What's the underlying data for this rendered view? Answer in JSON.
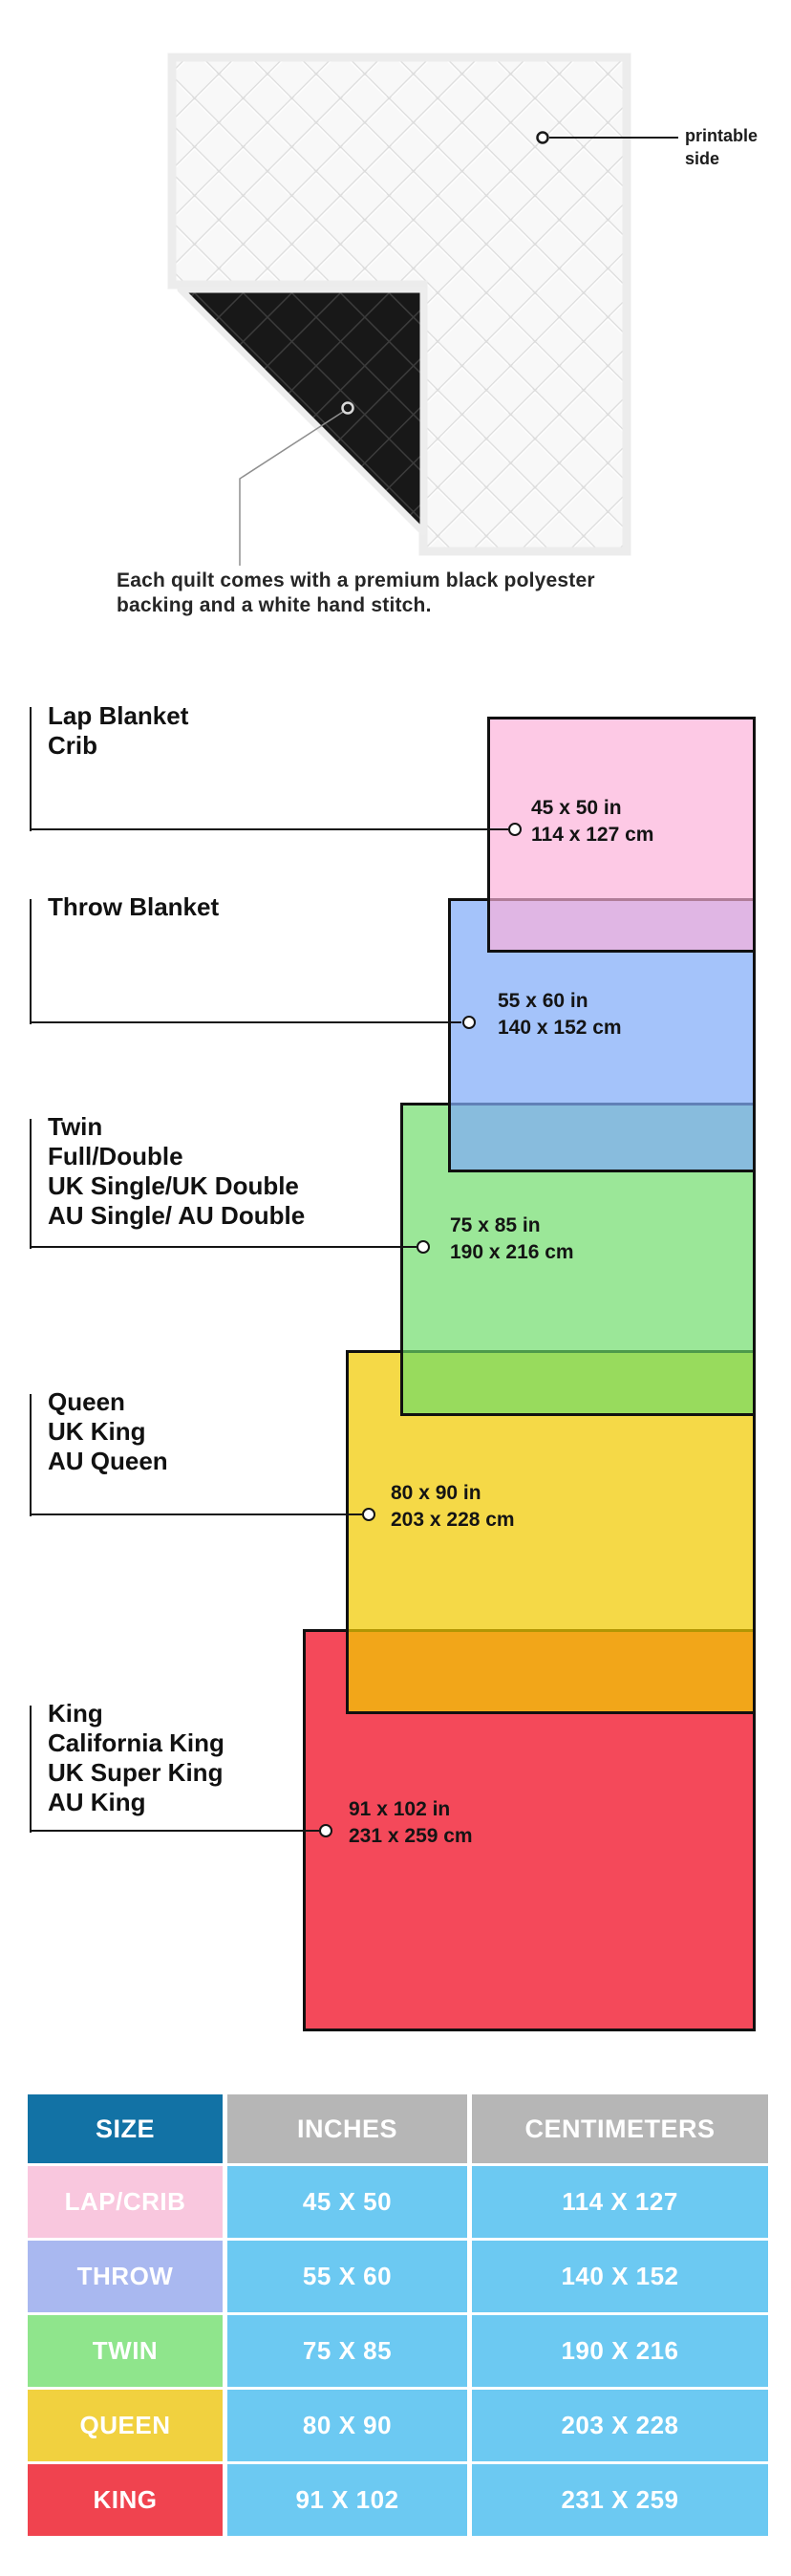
{
  "hero": {
    "printable": {
      "line1": "printable",
      "line2": "side"
    },
    "caption": {
      "line1": "Each quilt comes with a premium black polyester",
      "line2": "backing and a white hand stitch."
    },
    "quilt_front_color": "#f4f4f4",
    "quilt_back_color": "#181818"
  },
  "diagram": {
    "sizes": [
      {
        "id": "lap",
        "names": [
          "Lap Blanket",
          "Crib"
        ],
        "inches": "45 x 50 in",
        "cm": "114 x 127 cm",
        "color": "#fdc9e4"
      },
      {
        "id": "throw",
        "names": [
          "Throw Blanket"
        ],
        "inches": "55 x 60 in",
        "cm": "140 x 152 cm",
        "color": "#a3c2f9"
      },
      {
        "id": "twin",
        "names": [
          "Twin",
          "Full/Double",
          "UK Single/UK Double",
          "AU Single/ AU Double"
        ],
        "inches": "75 x 85 in",
        "cm": "190 x 216 cm",
        "color": "#99e796"
      },
      {
        "id": "queen",
        "names": [
          "Queen",
          "UK King",
          "AU Queen"
        ],
        "inches": "80 x 90 in",
        "cm": "203 x 228 cm",
        "color": "#f5d945"
      },
      {
        "id": "king",
        "names": [
          "King",
          "California King",
          "UK Super King",
          "AU King"
        ],
        "inches": "91 x 102 in",
        "cm": "231 x 259 cm",
        "color": "#f4495a"
      }
    ],
    "overlap_colors": {
      "lap_throw": "#e2b8e9",
      "throw_twin": "#89bfe0",
      "twin_queen": "#96db5b",
      "queen_king": "#f2a629"
    },
    "border_color": "#101010"
  },
  "table": {
    "headers": [
      "SIZE",
      "INCHES",
      "CENTIMETERS"
    ],
    "rows": [
      {
        "size": "LAP/CRIB",
        "inches": "45 X 50",
        "cm": "114 X 127",
        "color": "#f9c7de"
      },
      {
        "size": "THROW",
        "inches": "55 X 60",
        "cm": "140 X 152",
        "color": "#a9b8f0"
      },
      {
        "size": "TWIN",
        "inches": "75 X 85",
        "cm": "190 X 216",
        "color": "#8fe58c"
      },
      {
        "size": "QUEEN",
        "inches": "80 X 90",
        "cm": "203 X 228",
        "color": "#f1d13f"
      },
      {
        "size": "KING",
        "inches": "91 X 102",
        "cm": "231 X 259",
        "color": "#f0434f"
      }
    ],
    "header_size_bg": "#1272a5",
    "header_gray_bg": "#b6b6b6",
    "value_cell_bg": "#6cc9f2"
  }
}
